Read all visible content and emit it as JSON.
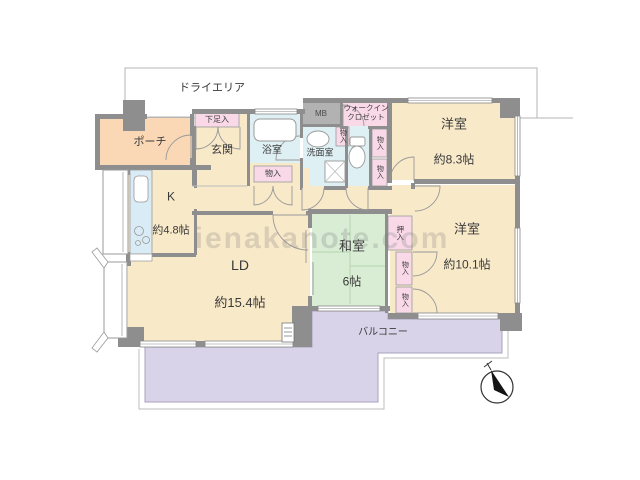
{
  "watermark": "ienakanote.com",
  "plan": {
    "dry_area": "ドライエリア",
    "porch": "ポーチ",
    "entrance": "玄関",
    "shoe_cabinet": "下足入",
    "bathroom": "浴室",
    "storage": "物入",
    "meter_box": "MB",
    "washroom": "洗面室",
    "walk_in_closet": "ウォークイン\nクロゼット",
    "closet": "押入",
    "western_room_1": {
      "name": "洋室",
      "size": "約8.3帖"
    },
    "western_room_2": {
      "name": "洋室",
      "size": "約10.1帖"
    },
    "japanese_room": {
      "name": "和室",
      "size": "6帖"
    },
    "kitchen": {
      "name": "K",
      "size": "約4.8帖"
    },
    "living_dining": {
      "name": "LD",
      "size": "約15.4帖"
    },
    "balcony": "バルコニー"
  },
  "colors": {
    "wall_gray": "#8e8e8e",
    "room_beige": "#f8e9c9",
    "porch_peach": "#fad8b6",
    "wet_area_blue": "#def0f4",
    "closet_pink": "#f9d9e8",
    "tatami_green": "#d9ecd4",
    "balcony_lavender": "#d9d3e9",
    "meter_box_gray": "#b2b2b2"
  }
}
